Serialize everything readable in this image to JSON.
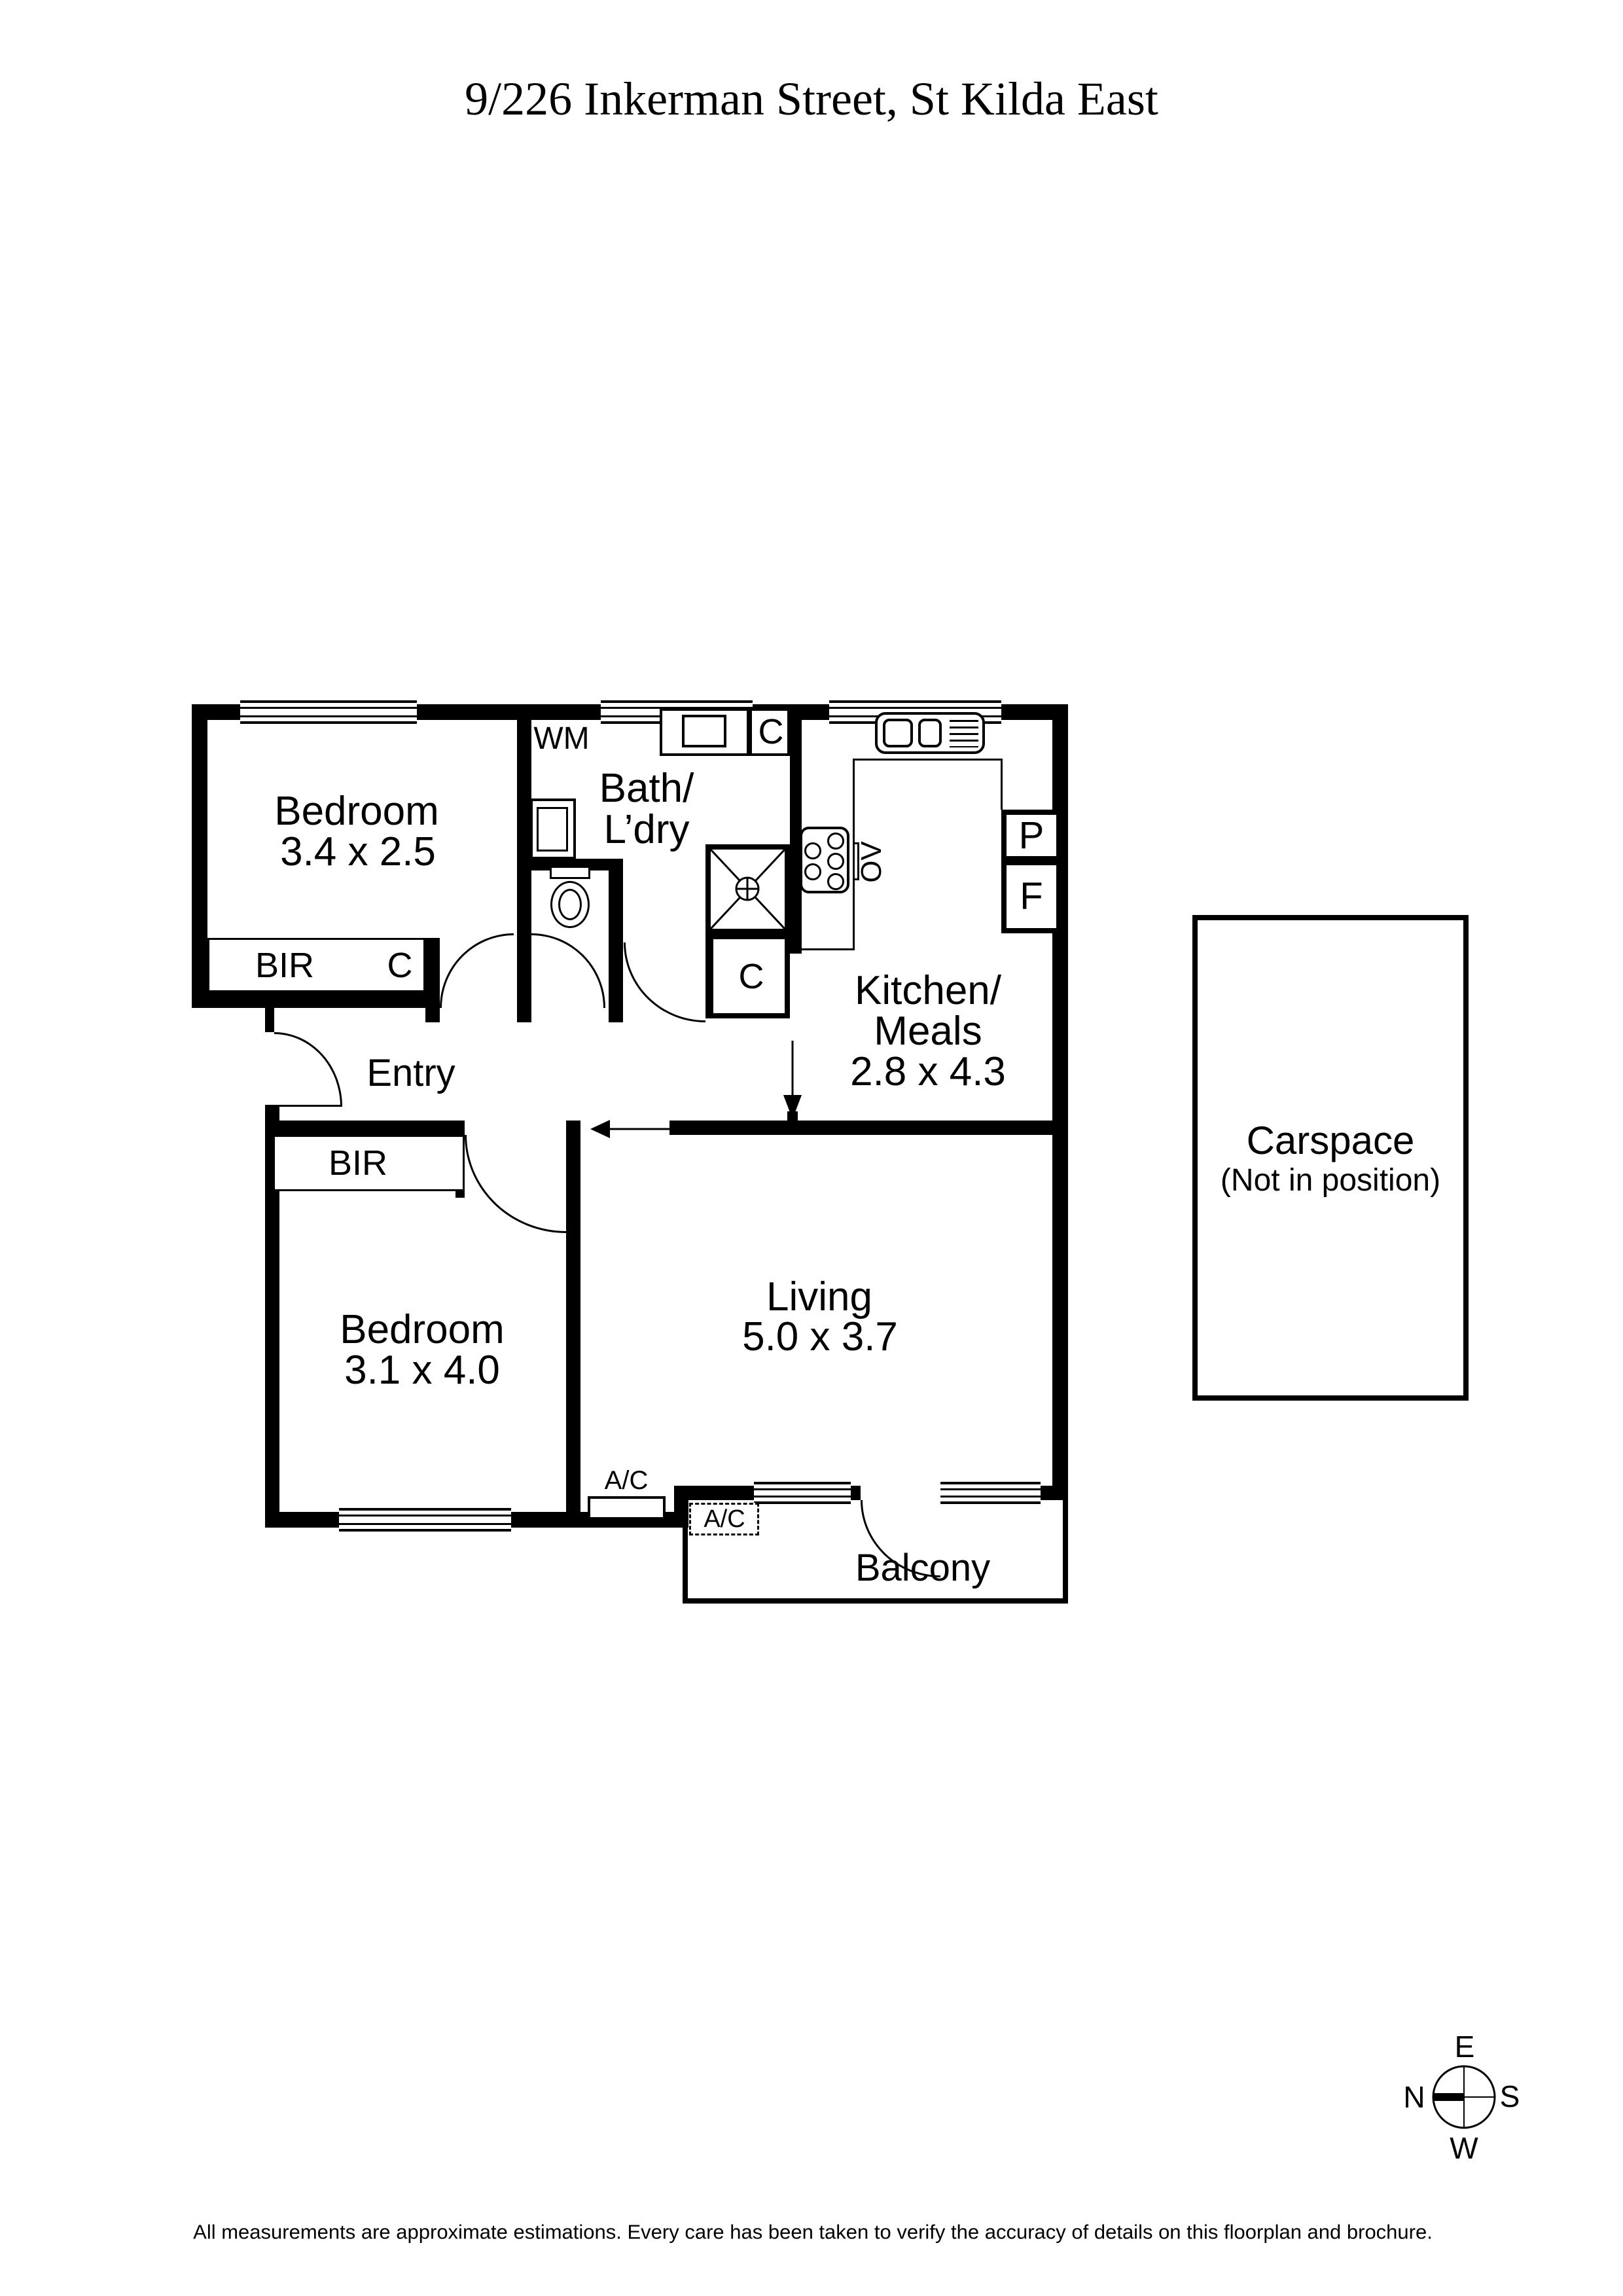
{
  "title": "9/226 Inkerman Street, St Kilda East",
  "footer": "All measurements are approximate estimations. Every care has been taken to verify the accuracy of details on this floorplan and brochure.",
  "colors": {
    "ink": "#000000",
    "paper": "#ffffff"
  },
  "rooms": {
    "bedroom1": {
      "name": "Bedroom",
      "dims": "3.4 x 2.5"
    },
    "bath": {
      "name_line1": "Bath/",
      "name_line2": "L’dry"
    },
    "kitchen": {
      "name_line1": "Kitchen/",
      "name_line2": "Meals",
      "dims": "2.8 x 4.3"
    },
    "entry": {
      "name": "Entry"
    },
    "bedroom2": {
      "name": "Bedroom",
      "dims": "3.1 x 4.0"
    },
    "living": {
      "name": "Living",
      "dims": "5.0 x 3.7"
    },
    "balcony": {
      "name": "Balcony"
    },
    "carspace": {
      "name": "Carspace",
      "note": "(Not in position)"
    }
  },
  "fixtures": {
    "wm": "WM",
    "bir": "BIR",
    "cupboard": "C",
    "pantry": "P",
    "fridge": "F",
    "oven": "OV",
    "ac": "A/C"
  },
  "compass": {
    "n": "N",
    "e": "E",
    "s": "S",
    "w": "W"
  }
}
